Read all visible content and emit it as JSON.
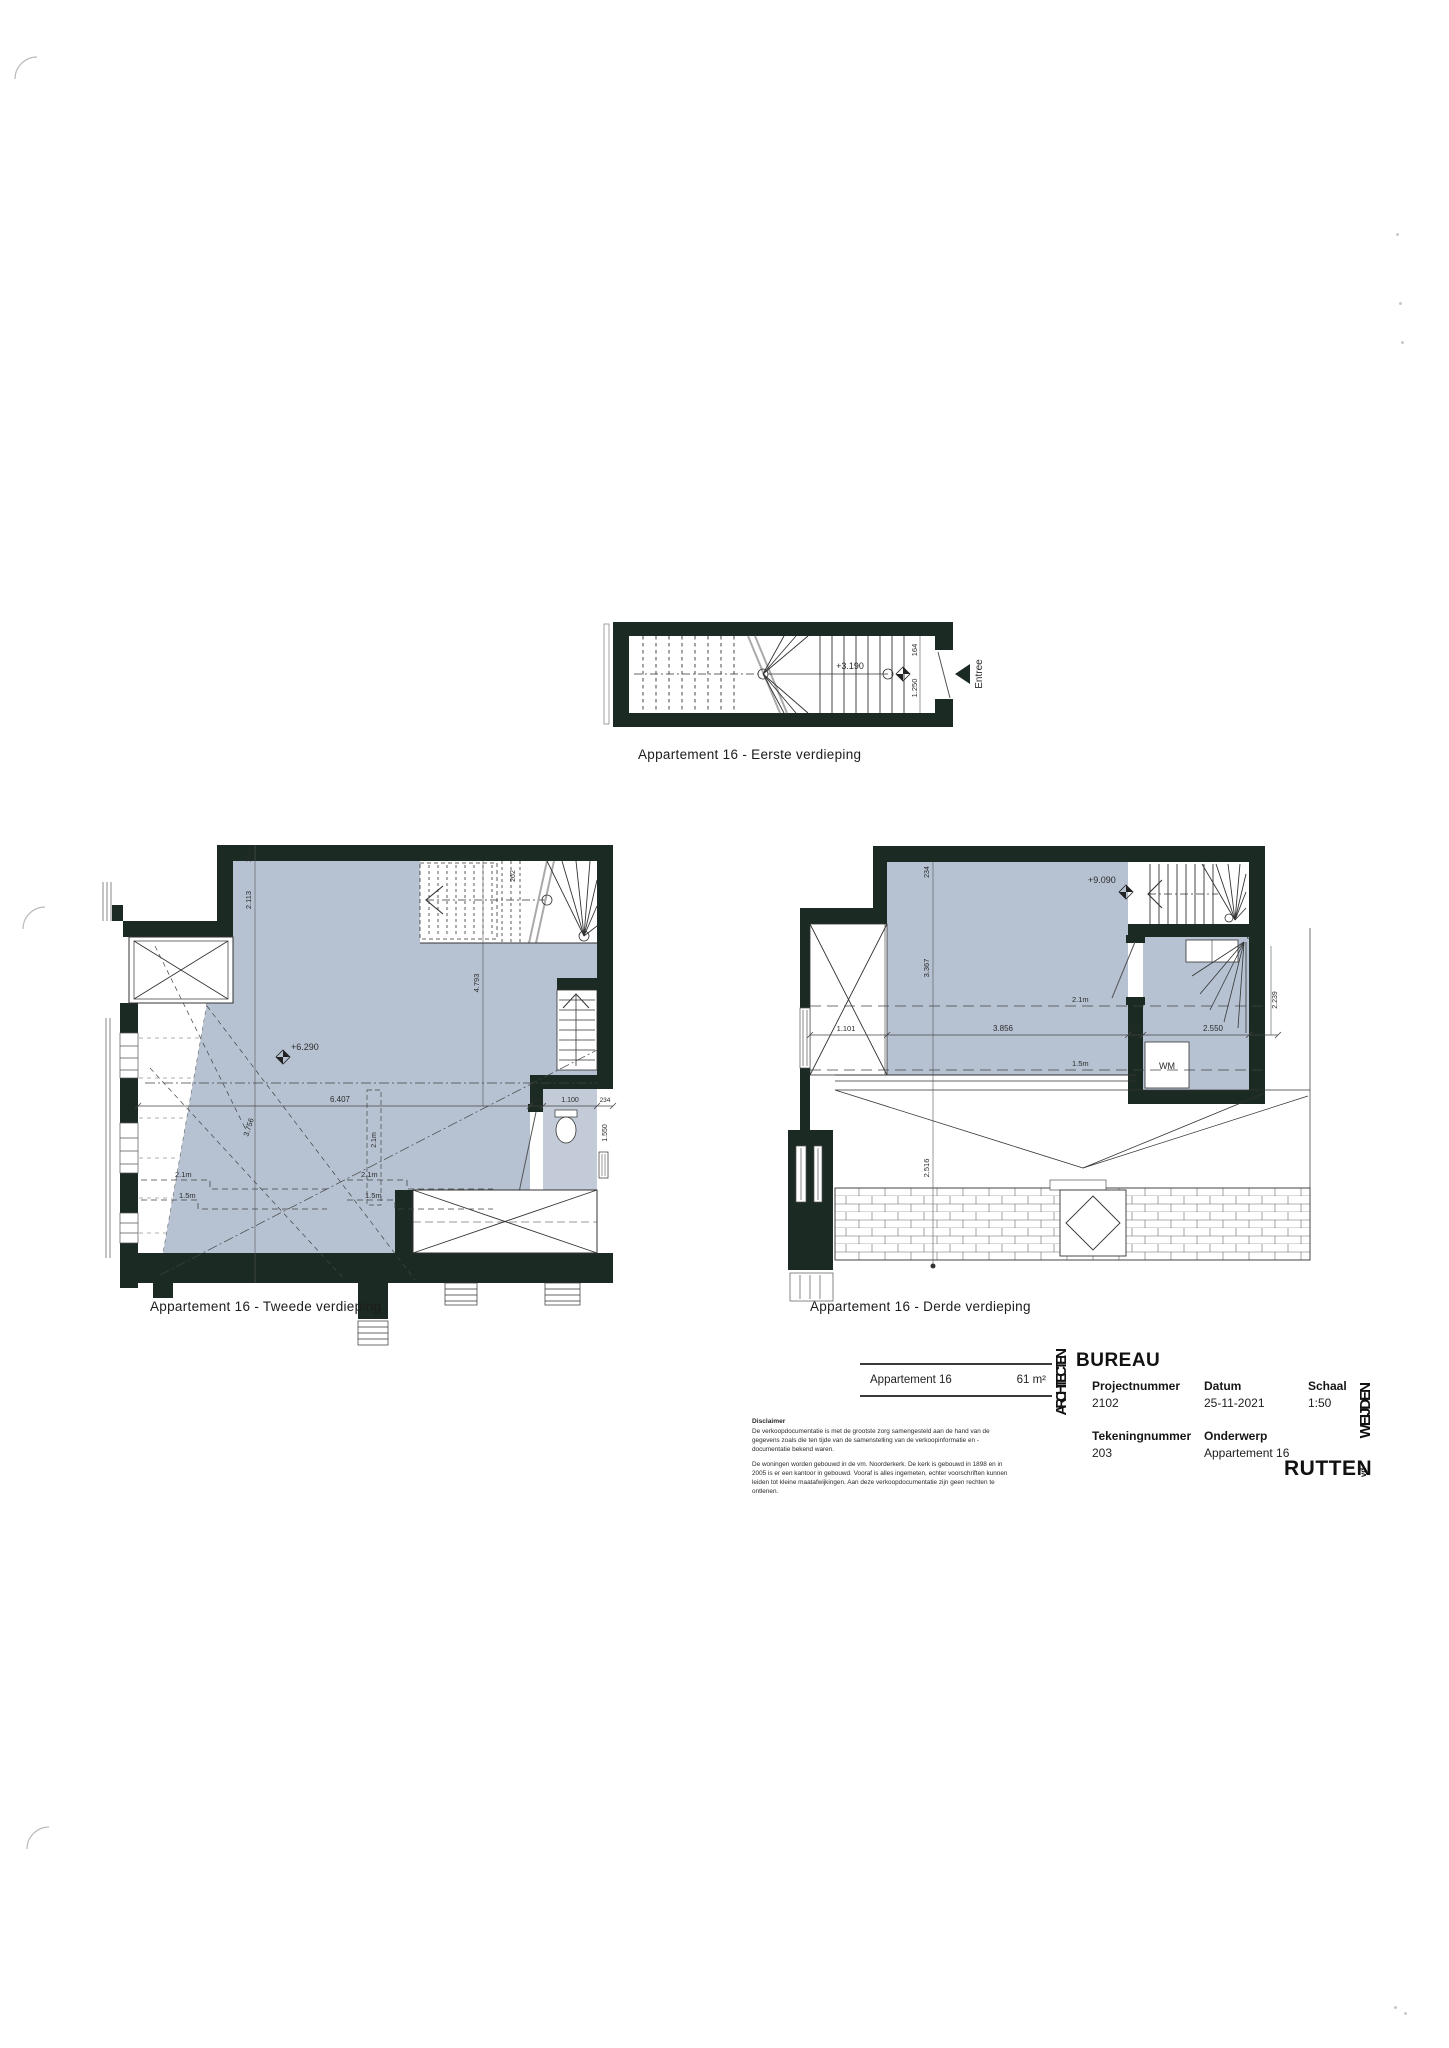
{
  "colors": {
    "wall": "#1b2a23",
    "room": "#b6c2d2",
    "room_light": "#c2cbd7",
    "ink": "#2b2b2b"
  },
  "plan1": {
    "caption": "Appartement 16 - Eerste verdieping",
    "level": "+3.190",
    "dim_164": "164",
    "dim_1250": "1.250",
    "entree": "Entree"
  },
  "plan2": {
    "caption": "Appartement 16 - Tweede verdieping",
    "level": "+6.290",
    "dims": {
      "d262a": "262",
      "d2113": "2.113",
      "d262b": "262",
      "d4793": "4.793",
      "d6407": "6.407",
      "d3756": "3.756",
      "d124": "124",
      "d1100": "1.100",
      "d234": "234",
      "d1550": "1.550",
      "h21a": "2.1m",
      "h15a": "1.5m",
      "h21b": "2.1m",
      "h15b": "1.5m",
      "h21c": "2.1m"
    }
  },
  "plan3": {
    "caption": "Appartement 16 - Derde verdieping",
    "level": "+9.090",
    "room_wm": "WM",
    "dims": {
      "d234": "234",
      "d3367": "3.367",
      "d1101": "1.101",
      "d3856": "3.856",
      "d124": "124",
      "d2550": "2.550",
      "d2239": "2.239",
      "d2516": "2.516",
      "h21": "2.1m",
      "h15": "1.5m",
      "corner_a": "a"
    }
  },
  "titleblock": {
    "table": {
      "name": "Appartement 16",
      "area": "61 m²"
    },
    "disclaimer_title": "Disclaimer",
    "disclaimer_p1": "De verkoopdocumentatie is met de grootste zorg samengesteld aan de hand van de gegevens zoals die ten tijde van de samenstelling van de verkoopinformatie en -documentatie bekend waren.",
    "disclaimer_p2": "De woningen worden gebouwd in de vm. Noorderkerk. De kerk is gebouwd in 1898 en in 2005 is er een kantoor in gebouwd. Vooraf is alles ingemeten, echter voorschriften kunnen leiden tot kleine maatafwijkingen. Aan deze verkoopdocumentatie zijn geen rechten te ontlenen.",
    "brand_vertical": "ARCHITECTEN",
    "brand_horizontal": "BUREAU",
    "fields": {
      "projectnummer_label": "Projectnummer",
      "projectnummer": "2102",
      "datum_label": "Datum",
      "datum": "25-11-2021",
      "schaal_label": "Schaal",
      "schaal": "1:50",
      "tekeningnummer_label": "Tekeningnummer",
      "tekeningnummer": "203",
      "onderwerp_label": "Onderwerp",
      "onderwerp": "Appartement 16"
    },
    "logo": {
      "part1": "RUTTEN",
      "part2": "vd",
      "part3": "WEIJDEN"
    }
  }
}
